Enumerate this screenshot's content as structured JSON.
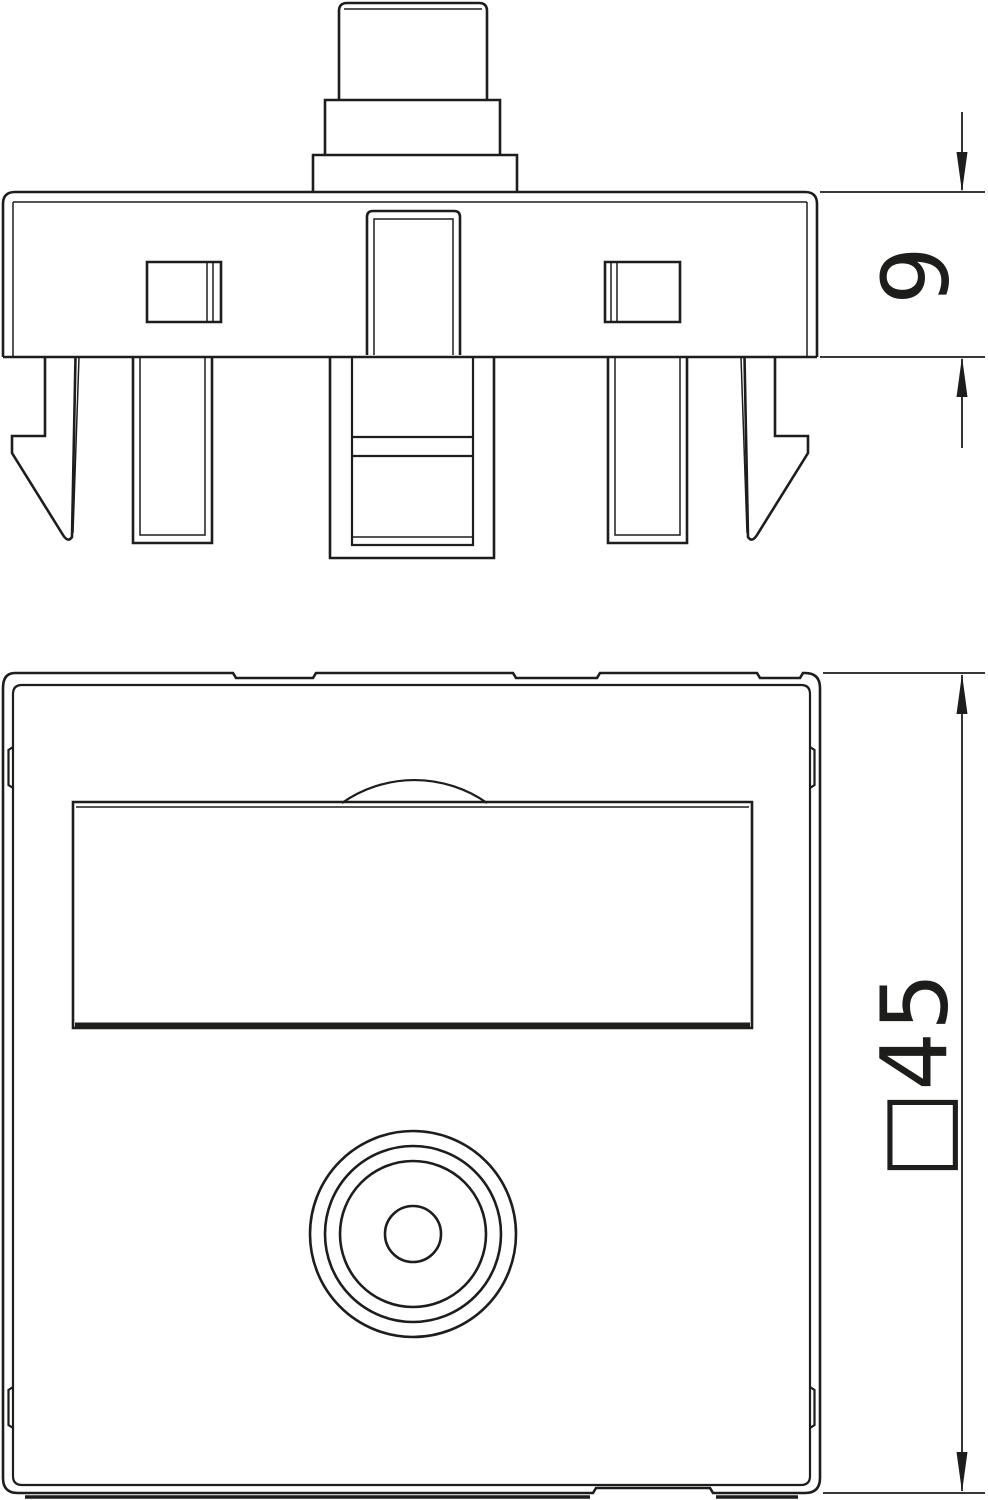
{
  "colors": {
    "line": "#1d1d1b",
    "background": "#ffffff"
  },
  "dimensions": {
    "depth_label": "9",
    "face_label": "□45",
    "depth_value": "9",
    "face_symbol": "□",
    "face_value": "45"
  }
}
